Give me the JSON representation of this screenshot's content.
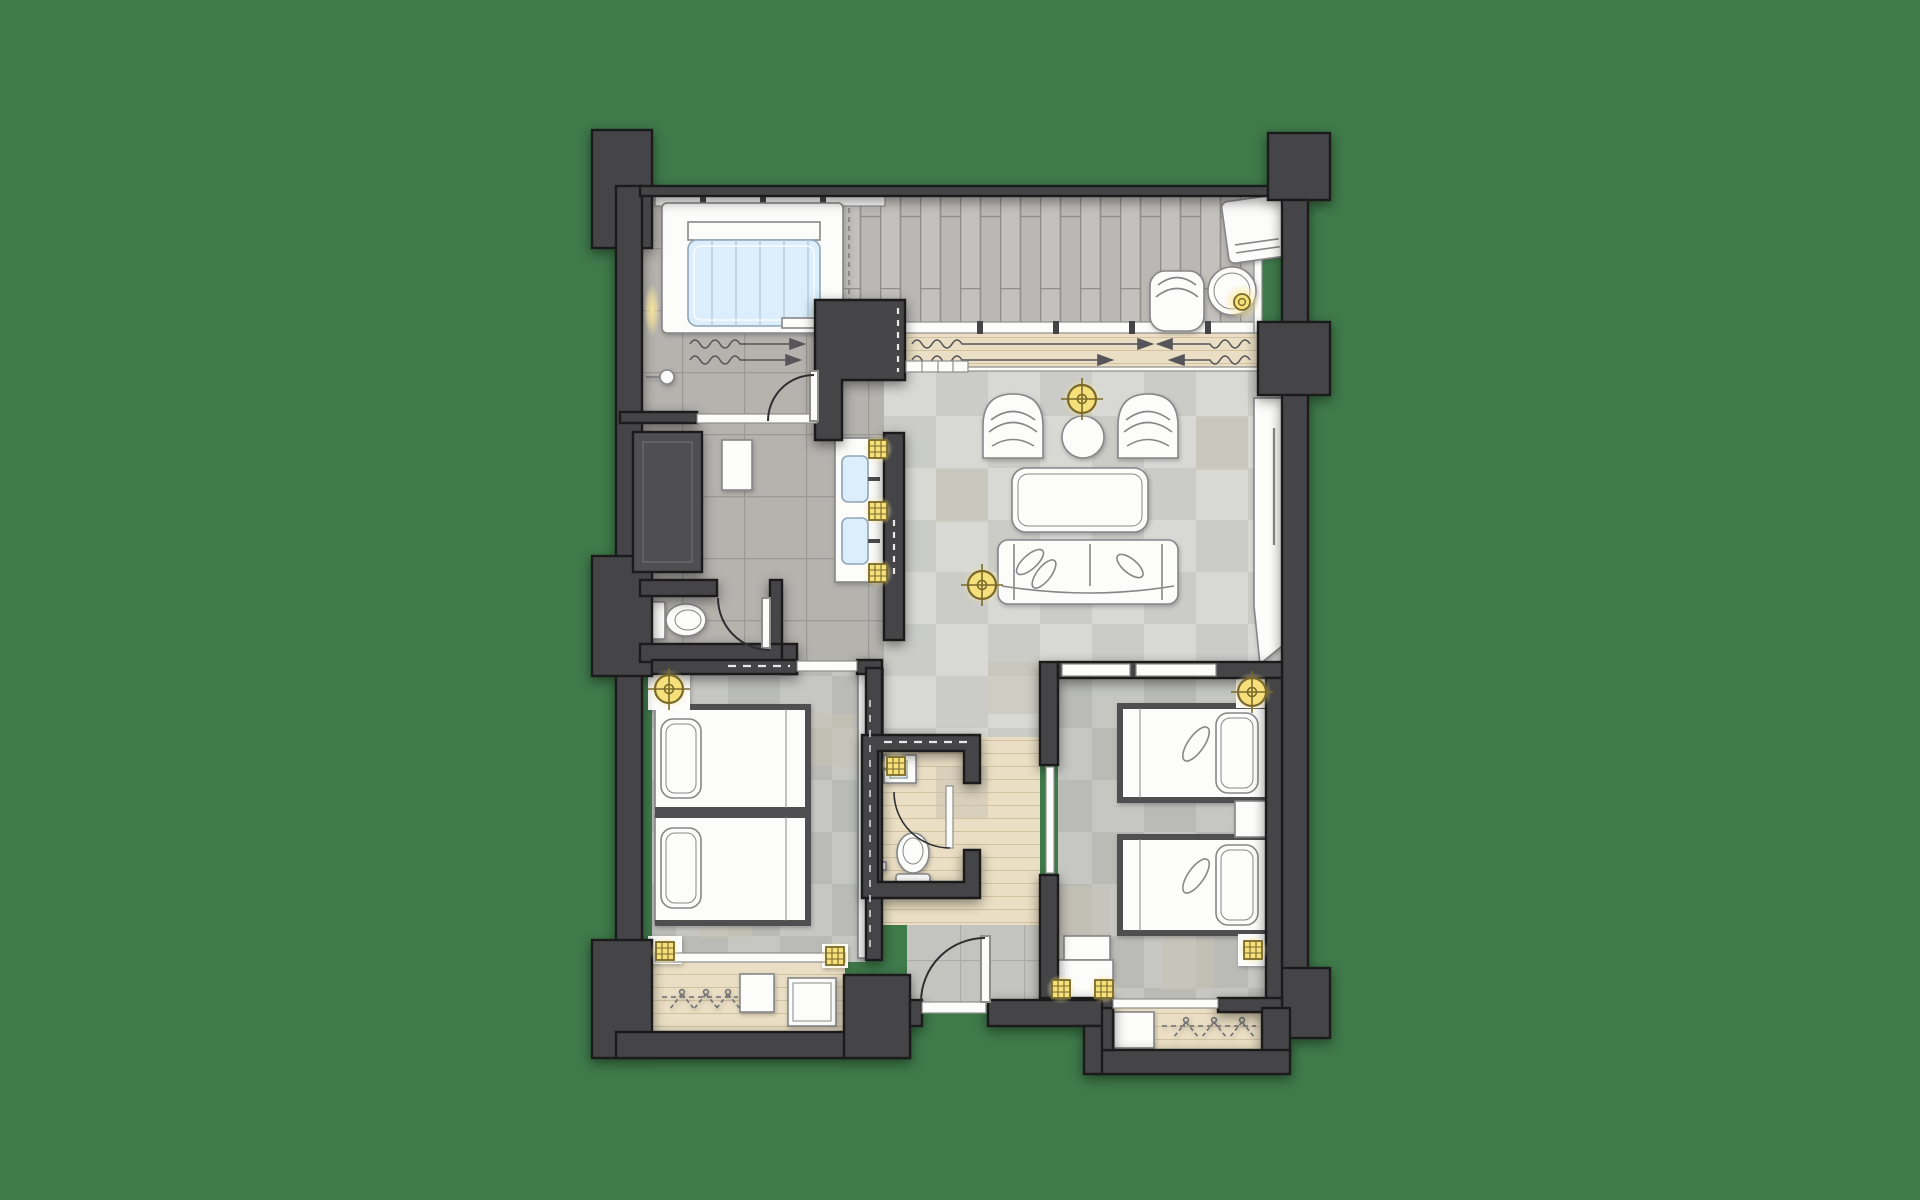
{
  "title": "hotel-suite-floor-plan",
  "background": "#3f7a4b",
  "colors": {
    "wall": "#454547",
    "wallLight": "#4f4f51",
    "wallStroke": "#1b1b1b",
    "stoneTile": "#b5b3ae",
    "stoneGrout": "#9b9994",
    "plank": "#c2c1bd",
    "plankAlt": "#b9b8b4",
    "plankGrout": "#8f8e8a",
    "checkerA": "#d8d9d5",
    "checkerB": "#cbccc8",
    "checkerC": "#c6c7c3",
    "checkerD": "#babbb7",
    "accentTaupe": "#c8c2b4",
    "wood": "#eadfc4",
    "woodLine": "#d3c2a0",
    "entryTile": "#c3c4c0",
    "entryGrout": "#abaca8",
    "white": "#fcfcfb",
    "furnitureStroke": "#87878a",
    "glassBlue": "#dceefb",
    "glassStroke": "#8fa6b8",
    "lightFill": "#f6e07c",
    "lightStroke": "#7a6a2a",
    "glow": "#f9e79b",
    "arrow": "#55555a",
    "door": "#2e2e30",
    "track": "#8e8e8a"
  },
  "rooms": [
    "balcony-terrace",
    "bathroom",
    "vanity-area",
    "wc-1",
    "wc-2",
    "hallway",
    "living-room",
    "bedroom-1",
    "bedroom-2",
    "entry",
    "closet-1",
    "closet-2"
  ],
  "furniture": [
    "bathtub",
    "shower-mixer",
    "double-sink-vanity",
    "wardrobe-block",
    "toilet-1",
    "toilet-2",
    "mini-sink",
    "lounge-chair",
    "terrace-armchair",
    "terrace-side-table",
    "table-lamp",
    "barrel-armchair-1",
    "barrel-armchair-2",
    "round-side-table",
    "dining-table",
    "sofa",
    "floor-lamp",
    "twin-bed-1a",
    "twin-bed-1b",
    "twin-bed-2a",
    "twin-bed-2b",
    "nightstand",
    "bench",
    "luggage-rack",
    "closet-hangers",
    "drawer-box",
    "ceiling-light",
    "downlight",
    "sliding-door-arrows",
    "entry-door"
  ],
  "lights": {
    "crosshair_count": 4,
    "grid_downlight_count": 9,
    "table_lamp_count": 1
  }
}
